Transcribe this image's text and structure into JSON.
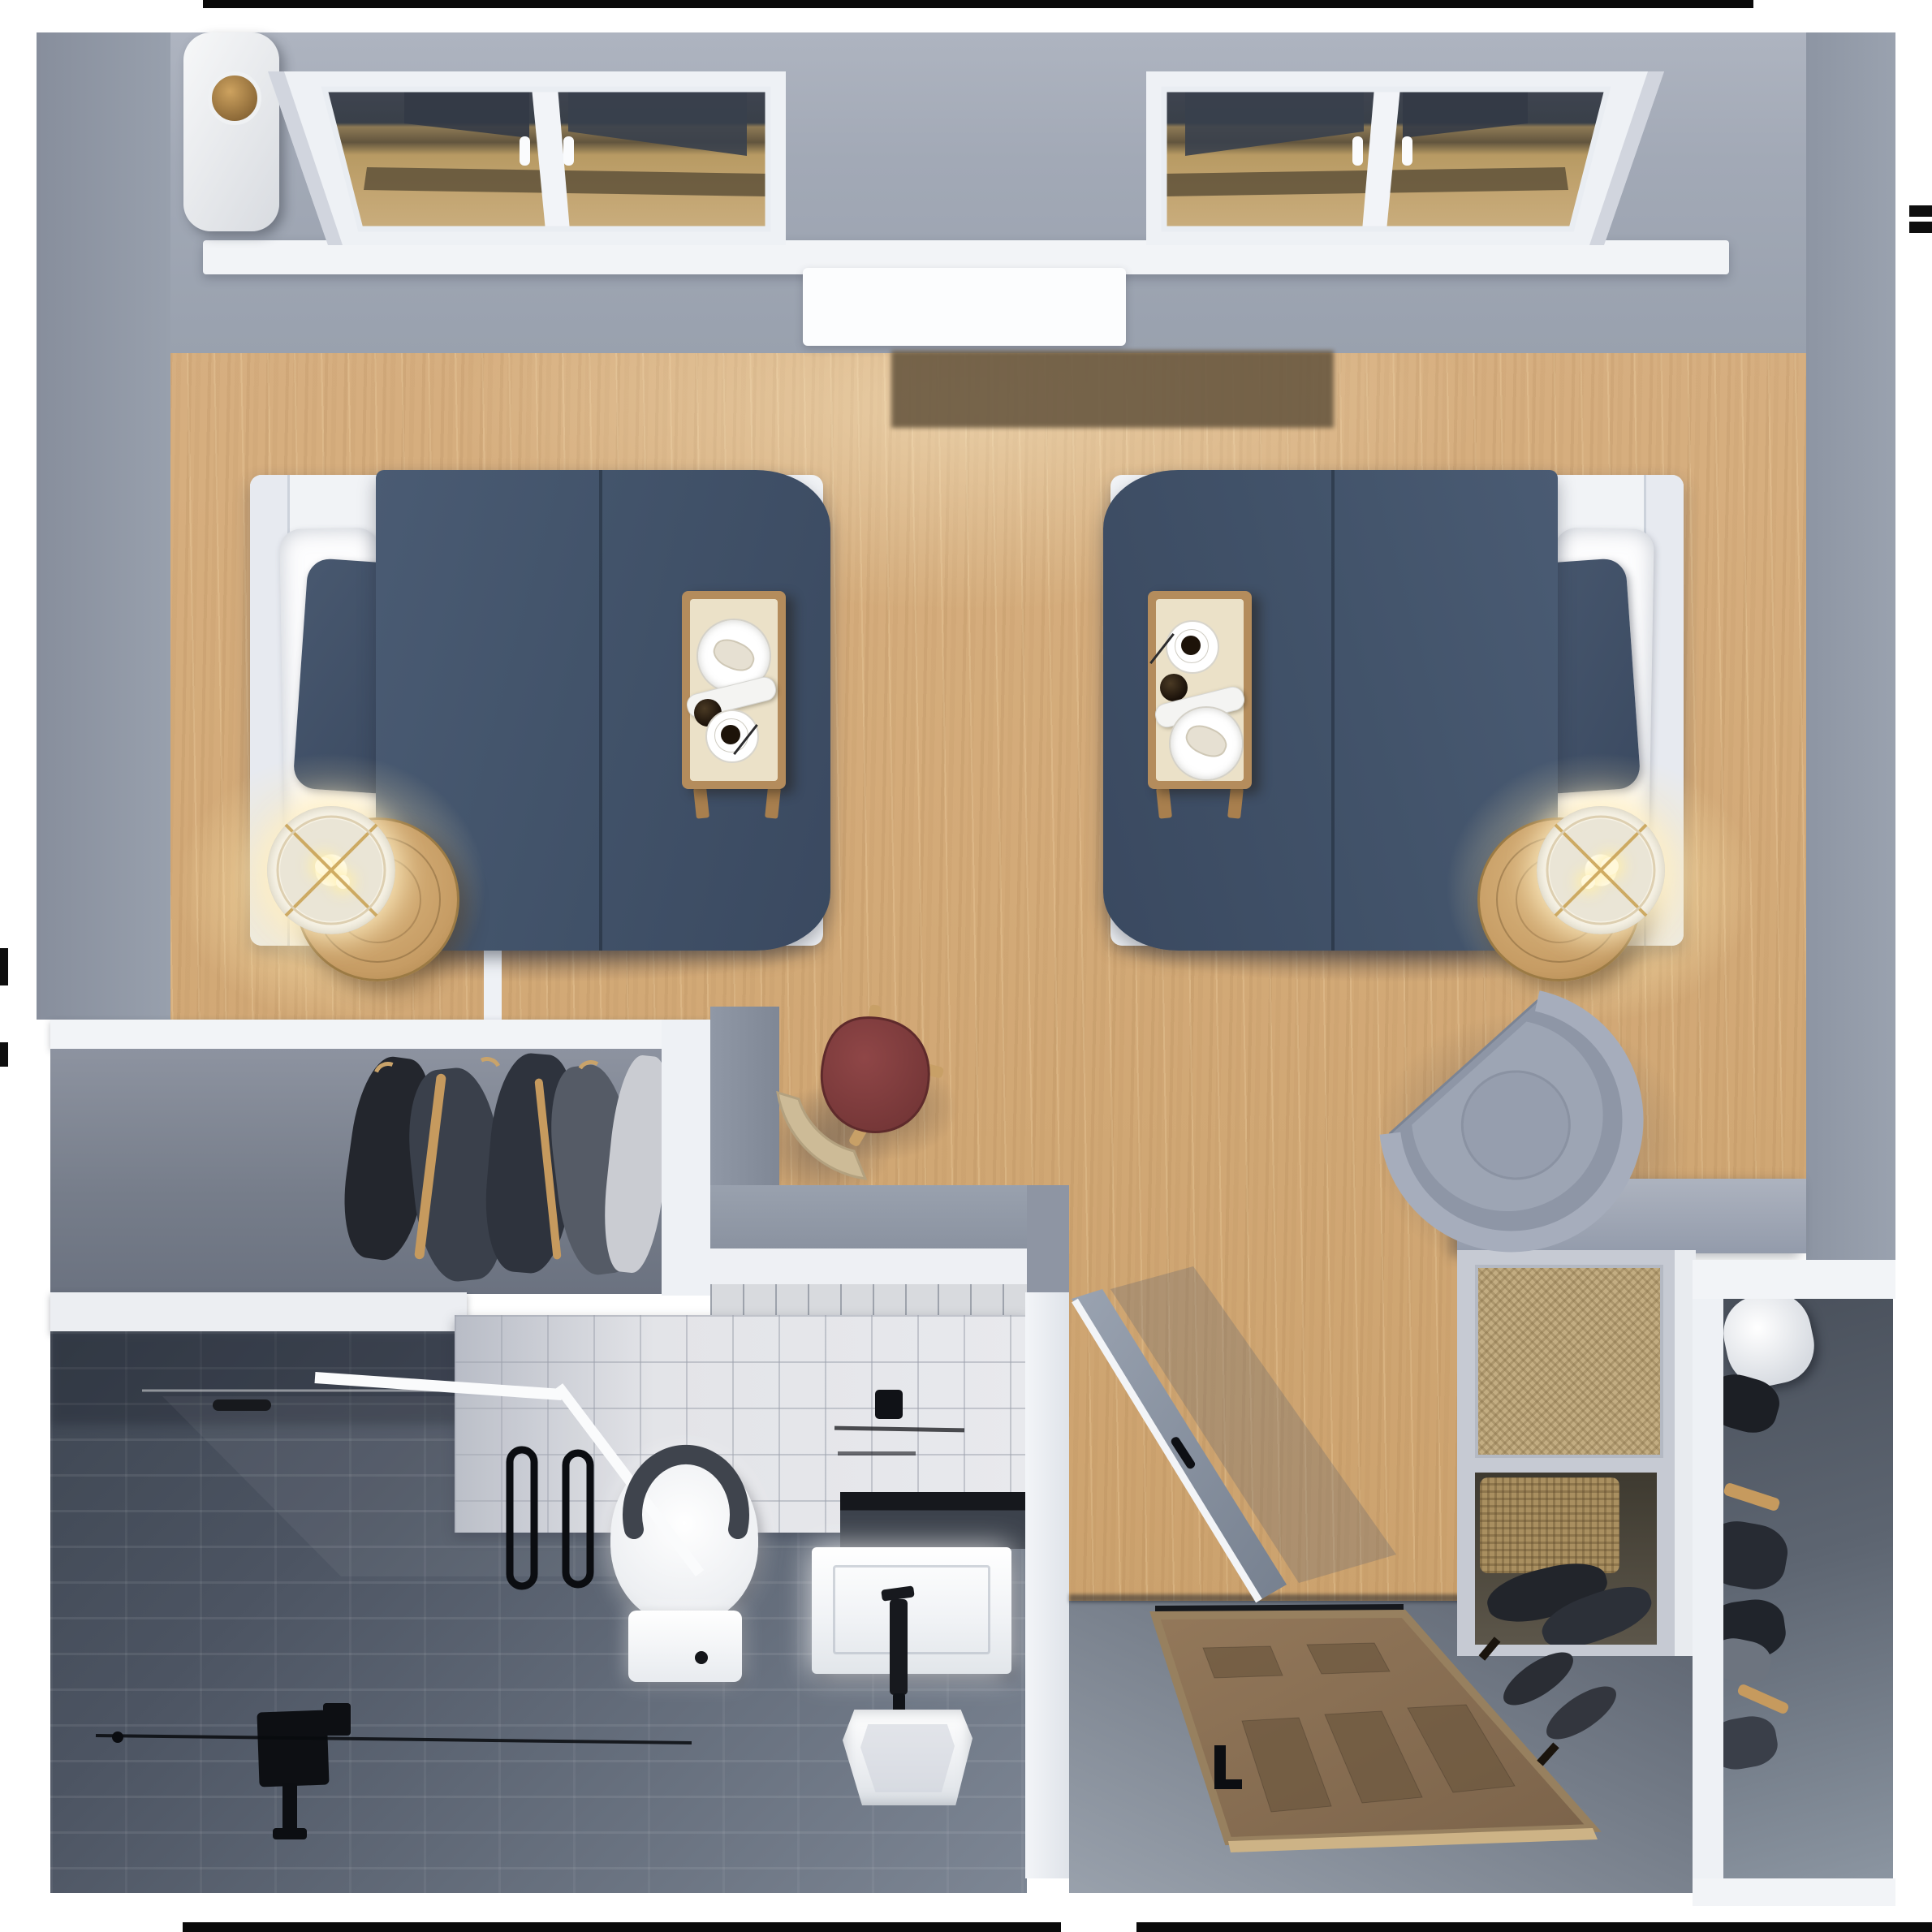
{
  "scene": {
    "kind": "3d-rendered top-down floor plan",
    "room": "shared senior-living bedroom suite with bathroom, two closets and entry",
    "visible_text": ""
  },
  "palette": {
    "wall_gray": "#99a1ae",
    "floor_wood": "#d3aa78",
    "bedding_navy": "#42536a",
    "linen_white": "#f2f4f7",
    "tray_wood": "#b48c5c",
    "lamp_glow": "#ffe9b2",
    "accent_maroon": "#7e3a3b",
    "bath_tile_dark": "#4c5462",
    "bath_tile_light": "#e3e4e8",
    "door_wood": "#8a7050",
    "cane_tan": "#c3ad82",
    "chair_gray": "#9199a8"
  },
  "objects": {
    "window_left": {
      "label": "window with dark glass (left)"
    },
    "window_right": {
      "label": "window with dark glass (right)"
    },
    "bed_left": {
      "label": "twin bed with navy duvet (left)"
    },
    "bed_right": {
      "label": "twin bed with navy duvet (right)"
    },
    "tray_left": {
      "label": "overbed tray with plate, coffee and newspaper"
    },
    "tray_right": {
      "label": "overbed tray with plate, coffee and newspaper"
    },
    "lamp_left": {
      "label": "round side table with lit drum lamp"
    },
    "lamp_right": {
      "label": "round side table with lit drum lamp"
    },
    "armchair": {
      "label": "gray rounded armchair"
    },
    "red_table": {
      "label": "maroon pick-shaped side table"
    },
    "stool": {
      "label": "tan curved stool"
    },
    "closet_left": {
      "label": "wardrobe with hanging clothes and hamper"
    },
    "closet_right": {
      "label": "closet with hanging clothes"
    },
    "dresser": {
      "label": "console with cane panel, basket and shoes"
    },
    "shower": {
      "label": "walk-in tiled shower with bench and grab bars"
    },
    "toilet": {
      "label": "toilet with grab bars"
    },
    "vanity": {
      "label": "floating vanity with sink, mirror and black faucet"
    },
    "bath_door": {
      "label": "open bathroom door"
    },
    "entry_door": {
      "label": "wood entry door"
    }
  }
}
